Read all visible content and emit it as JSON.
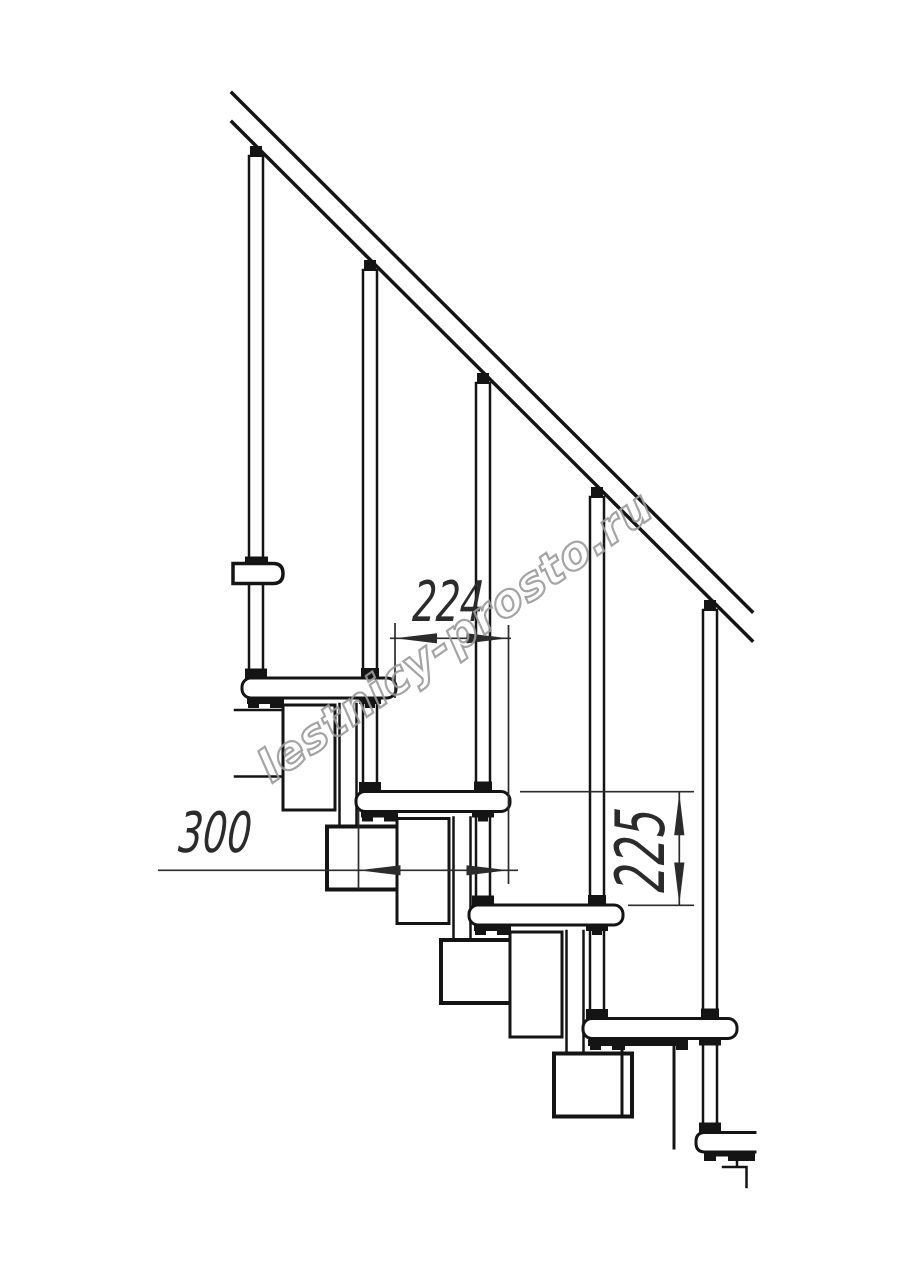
{
  "figure": {
    "type": "technical-drawing",
    "subject": "modular staircase side elevation with handrail, balusters and treads"
  },
  "dimensions": {
    "tread_offset": "224",
    "tread_depth": "300",
    "riser_height": "225"
  },
  "watermark": {
    "text": "lestnicy-prosto.ru"
  },
  "colors": {
    "line": "#141414",
    "dimension": "#2b2b2b",
    "watermark": "#9b9b9b",
    "background": "#ffffff"
  }
}
